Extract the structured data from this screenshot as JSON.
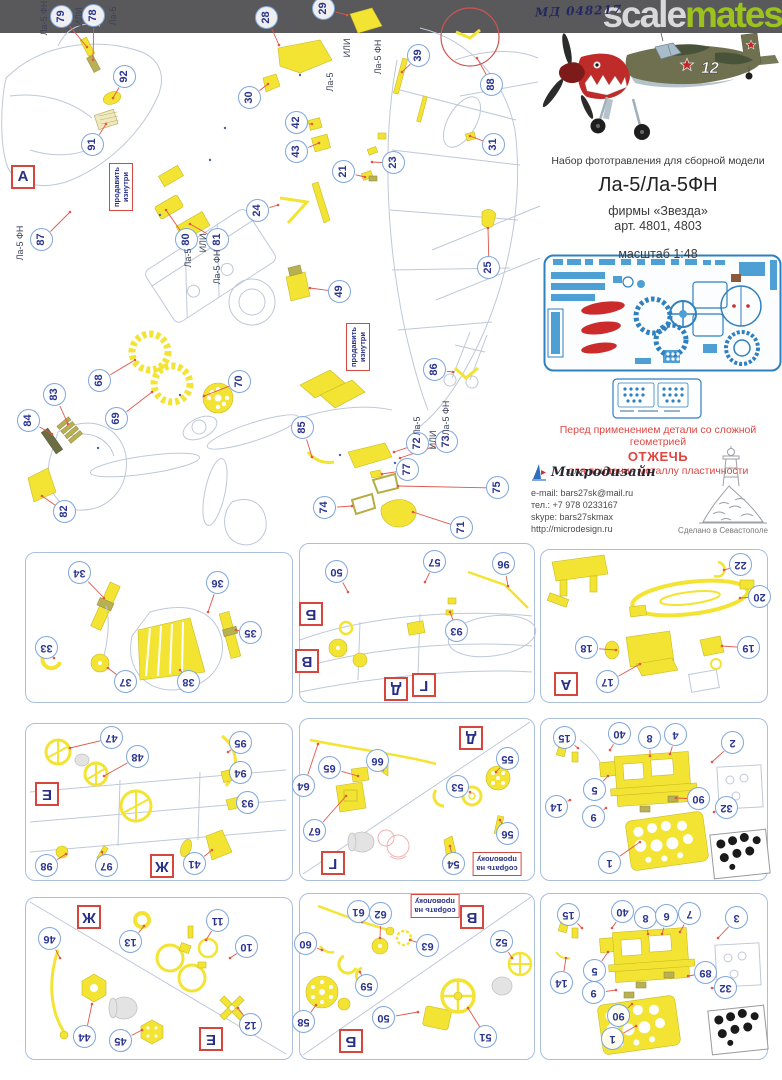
{
  "header": {
    "code": "МД 048217",
    "brand_gray": "scale",
    "brand_green": "mates"
  },
  "photo": {
    "number": "12"
  },
  "product": {
    "description": "Набор фототравления для сборной модели",
    "title": "Ла-5/Ла-5ФН",
    "brand": "фирмы «Звезда»",
    "articles": "арт. 4801, 4803",
    "scale": "масштаб 1:48"
  },
  "warning": {
    "line1": "Перед применением детали со сложной геометрией",
    "line2": "ОТЖЕЧЬ",
    "line3": "для придания металлу пластичности"
  },
  "publisher": {
    "name": "Микродизайн",
    "email": "e-mail: bars27sk@mail.ru",
    "phone": "тел.: +7 978 0233167",
    "skype": "skype: bars27skmax",
    "site": "http://microdesign.ru",
    "made_in": "Сделано в Севастополе"
  },
  "colors": {
    "accent_green": "#9cc21e",
    "callout_blue": "#2b3590",
    "leader_red": "#e2564b",
    "part_yellow": "#f3e433"
  },
  "diagram": {
    "markers": [
      {
        "t": "А",
        "x": 23,
        "y": 177
      }
    ],
    "labels": [
      {
        "t": "Ла-5 ФН",
        "x": 44,
        "y": 18
      },
      {
        "t": "ИЛИ",
        "x": 79,
        "y": 17
      },
      {
        "t": "Ла-5",
        "x": 113,
        "y": 16
      },
      {
        "t": "ИЛИ",
        "x": 347,
        "y": 48
      },
      {
        "t": "Ла-5 ФН",
        "x": 378,
        "y": 57
      },
      {
        "t": "Ла-5",
        "x": 330,
        "y": 82
      },
      {
        "t": "Ла-5 ФН",
        "x": 20,
        "y": 243
      },
      {
        "t": "Ла-5",
        "x": 188,
        "y": 258
      },
      {
        "t": "ИЛИ",
        "x": 203,
        "y": 243
      },
      {
        "t": "Ла-5 ФН",
        "x": 217,
        "y": 267
      },
      {
        "t": "Ла-5",
        "x": 417,
        "y": 426
      },
      {
        "t": "ИЛИ",
        "x": 433,
        "y": 440
      },
      {
        "t": "Ла-5 ФН",
        "x": 446,
        "y": 418
      }
    ],
    "notes": [
      {
        "lines": [
          "продавить",
          "изнутри"
        ],
        "x": 121,
        "y": 187
      },
      {
        "lines": [
          "продавить",
          "изнутри"
        ],
        "x": 358,
        "y": 347
      }
    ],
    "callouts": [
      {
        "n": "79",
        "x": 62,
        "y": 17,
        "tx": 87,
        "ty": 47
      },
      {
        "n": "78",
        "x": 94,
        "y": 16,
        "tx": 93,
        "ty": 60
      },
      {
        "n": "92",
        "x": 125,
        "y": 77,
        "tx": 113,
        "ty": 98
      },
      {
        "n": "91",
        "x": 93,
        "y": 145,
        "tx": 106,
        "ty": 124
      },
      {
        "n": "87",
        "x": 42,
        "y": 240,
        "tx": 70,
        "ty": 212
      },
      {
        "n": "80",
        "x": 187,
        "y": 240,
        "tx": 166,
        "ty": 210
      },
      {
        "n": "81",
        "x": 218,
        "y": 240,
        "tx": 190,
        "ty": 224
      },
      {
        "n": "28",
        "x": 267,
        "y": 18,
        "tx": 279,
        "ty": 45
      },
      {
        "n": "29",
        "x": 324,
        "y": 9,
        "tx": 347,
        "ty": 15
      },
      {
        "n": "30",
        "x": 250,
        "y": 98,
        "tx": 268,
        "ty": 84
      },
      {
        "n": "39",
        "x": 419,
        "y": 56,
        "tx": 402,
        "ty": 72
      },
      {
        "n": "88",
        "x": 492,
        "y": 85,
        "tx": 477,
        "ty": 58
      },
      {
        "n": "31",
        "x": 494,
        "y": 145,
        "tx": 470,
        "ty": 136
      },
      {
        "n": "42",
        "x": 297,
        "y": 123,
        "tx": 312,
        "ty": 124
      },
      {
        "n": "43",
        "x": 297,
        "y": 152,
        "tx": 319,
        "ty": 143
      },
      {
        "n": "21",
        "x": 344,
        "y": 172,
        "tx": 365,
        "ty": 177
      },
      {
        "n": "23",
        "x": 394,
        "y": 163,
        "tx": 372,
        "ty": 162
      },
      {
        "n": "24",
        "x": 258,
        "y": 211,
        "tx": 278,
        "ty": 205
      },
      {
        "n": "49",
        "x": 340,
        "y": 292,
        "tx": 310,
        "ty": 288
      },
      {
        "n": "25",
        "x": 489,
        "y": 268,
        "tx": 488,
        "ty": 228
      },
      {
        "n": "68",
        "x": 100,
        "y": 381,
        "tx": 135,
        "ty": 360
      },
      {
        "n": "83",
        "x": 55,
        "y": 395,
        "tx": 68,
        "ty": 424
      },
      {
        "n": "84",
        "x": 29,
        "y": 421,
        "tx": 52,
        "ty": 434
      },
      {
        "n": "69",
        "x": 117,
        "y": 419,
        "tx": 152,
        "ty": 392
      },
      {
        "n": "70",
        "x": 240,
        "y": 382,
        "tx": 204,
        "ty": 396
      },
      {
        "n": "82",
        "x": 65,
        "y": 512,
        "tx": 42,
        "ty": 496
      },
      {
        "n": "86",
        "x": 435,
        "y": 370,
        "tx": 453,
        "ty": 372
      },
      {
        "n": "85",
        "x": 303,
        "y": 428,
        "tx": 312,
        "ty": 457
      },
      {
        "n": "72",
        "x": 418,
        "y": 444,
        "tx": 394,
        "ty": 452
      },
      {
        "n": "73",
        "x": 447,
        "y": 442,
        "tx": 400,
        "ty": 458
      },
      {
        "n": "77",
        "x": 408,
        "y": 470,
        "tx": 382,
        "ty": 474
      },
      {
        "n": "75",
        "x": 498,
        "y": 488,
        "tx": 398,
        "ty": 486
      },
      {
        "n": "74",
        "x": 325,
        "y": 508,
        "tx": 352,
        "ty": 506
      },
      {
        "n": "71",
        "x": 462,
        "y": 528,
        "tx": 413,
        "ty": 512
      }
    ]
  },
  "panels": [
    {
      "id": "panel-1",
      "x": 25,
      "y": 552,
      "w": 266,
      "h": 149,
      "letters": [],
      "notes": [],
      "callouts": [
        {
          "n": "34",
          "x": 80,
          "y": 573,
          "tx": 104,
          "ty": 598
        },
        {
          "n": "36",
          "x": 218,
          "y": 583,
          "tx": 208,
          "ty": 612
        },
        {
          "n": "33",
          "x": 47,
          "y": 648,
          "tx": 54,
          "ty": 658
        },
        {
          "n": "35",
          "x": 251,
          "y": 633,
          "tx": 236,
          "ty": 630
        },
        {
          "n": "37",
          "x": 126,
          "y": 682,
          "tx": 108,
          "ty": 668
        },
        {
          "n": "38",
          "x": 189,
          "y": 682,
          "tx": 180,
          "ty": 670
        }
      ]
    },
    {
      "id": "panel-2",
      "x": 299,
      "y": 543,
      "w": 234,
      "h": 158,
      "letters": [
        {
          "t": "Б",
          "x": 311,
          "y": 614
        },
        {
          "t": "В",
          "x": 307,
          "y": 661
        },
        {
          "t": "Д",
          "x": 396,
          "y": 689
        },
        {
          "t": "Г",
          "x": 424,
          "y": 685
        }
      ],
      "notes": [],
      "callouts": [
        {
          "n": "50",
          "x": 337,
          "y": 572,
          "tx": 348,
          "ty": 592
        },
        {
          "n": "57",
          "x": 435,
          "y": 562,
          "tx": 425,
          "ty": 582
        },
        {
          "n": "96",
          "x": 504,
          "y": 564,
          "tx": 508,
          "ty": 586
        },
        {
          "n": "93",
          "x": 457,
          "y": 631,
          "tx": 450,
          "ty": 612
        }
      ]
    },
    {
      "id": "panel-3",
      "x": 540,
      "y": 549,
      "w": 226,
      "h": 152,
      "letters": [
        {
          "t": "А",
          "x": 566,
          "y": 684
        }
      ],
      "notes": [],
      "callouts": [
        {
          "n": "22",
          "x": 741,
          "y": 565,
          "tx": 724,
          "ty": 570
        },
        {
          "n": "20",
          "x": 760,
          "y": 597,
          "tx": 740,
          "ty": 598
        },
        {
          "n": "18",
          "x": 587,
          "y": 648,
          "tx": 616,
          "ty": 650
        },
        {
          "n": "19",
          "x": 749,
          "y": 648,
          "tx": 722,
          "ty": 646
        },
        {
          "n": "17",
          "x": 608,
          "y": 682,
          "tx": 640,
          "ty": 664
        }
      ]
    },
    {
      "id": "panel-4",
      "x": 25,
      "y": 723,
      "w": 266,
      "h": 156,
      "letters": [
        {
          "t": "Е",
          "x": 47,
          "y": 794
        },
        {
          "t": "Ж",
          "x": 162,
          "y": 866
        }
      ],
      "notes": [],
      "callouts": [
        {
          "n": "47",
          "x": 112,
          "y": 738,
          "tx": 70,
          "ty": 748
        },
        {
          "n": "48",
          "x": 138,
          "y": 757,
          "tx": 104,
          "ty": 776
        },
        {
          "n": "95",
          "x": 241,
          "y": 743,
          "tx": 228,
          "ty": 752
        },
        {
          "n": "94",
          "x": 241,
          "y": 773,
          "tx": 232,
          "ty": 774
        },
        {
          "n": "93",
          "x": 248,
          "y": 803,
          "tx": 238,
          "ty": 800
        },
        {
          "n": "98",
          "x": 47,
          "y": 866,
          "tx": 66,
          "ty": 854
        },
        {
          "n": "97",
          "x": 107,
          "y": 866,
          "tx": 102,
          "ty": 852
        },
        {
          "n": "41",
          "x": 195,
          "y": 864,
          "tx": 212,
          "ty": 850
        }
      ]
    },
    {
      "id": "panel-5",
      "x": 299,
      "y": 718,
      "w": 234,
      "h": 161,
      "letters": [
        {
          "t": "Д",
          "x": 471,
          "y": 738
        },
        {
          "t": "Г",
          "x": 333,
          "y": 863
        }
      ],
      "notes": [
        {
          "lines": [
            "собрать на",
            "проволоку"
          ],
          "x": 497,
          "y": 864
        }
      ],
      "callouts": [
        {
          "n": "64",
          "x": 304,
          "y": 786,
          "tx": 318,
          "ty": 744
        },
        {
          "n": "65",
          "x": 330,
          "y": 768,
          "tx": 358,
          "ty": 776
        },
        {
          "n": "66",
          "x": 378,
          "y": 761,
          "tx": 382,
          "ty": 768
        },
        {
          "n": "67",
          "x": 315,
          "y": 831,
          "tx": 346,
          "ty": 796
        },
        {
          "n": "55",
          "x": 508,
          "y": 759,
          "tx": 496,
          "ty": 772
        },
        {
          "n": "53",
          "x": 458,
          "y": 787,
          "tx": 470,
          "ty": 792
        },
        {
          "n": "56",
          "x": 508,
          "y": 834,
          "tx": 500,
          "ty": 820
        },
        {
          "n": "54",
          "x": 454,
          "y": 864,
          "tx": 450,
          "ty": 846
        }
      ]
    },
    {
      "id": "panel-6",
      "x": 540,
      "y": 718,
      "w": 226,
      "h": 161,
      "letters": [],
      "notes": [],
      "callouts": [
        {
          "n": "15",
          "x": 565,
          "y": 738,
          "tx": 578,
          "ty": 748
        },
        {
          "n": "40",
          "x": 620,
          "y": 734,
          "tx": 610,
          "ty": 750
        },
        {
          "n": "8",
          "x": 650,
          "y": 738,
          "tx": 650,
          "ty": 756
        },
        {
          "n": "4",
          "x": 676,
          "y": 735,
          "tx": 670,
          "ty": 754
        },
        {
          "n": "2",
          "x": 733,
          "y": 743,
          "tx": 712,
          "ty": 762
        },
        {
          "n": "5",
          "x": 595,
          "y": 790,
          "tx": 608,
          "ty": 776
        },
        {
          "n": "14",
          "x": 557,
          "y": 807,
          "tx": 570,
          "ty": 800
        },
        {
          "n": "9",
          "x": 594,
          "y": 817,
          "tx": 606,
          "ty": 808
        },
        {
          "n": "90",
          "x": 699,
          "y": 799,
          "tx": 676,
          "ty": 798
        },
        {
          "n": "32",
          "x": 727,
          "y": 808,
          "tx": 714,
          "ty": 812
        },
        {
          "n": "1",
          "x": 610,
          "y": 863,
          "tx": 640,
          "ty": 842
        }
      ]
    },
    {
      "id": "panel-7",
      "x": 25,
      "y": 897,
      "w": 266,
      "h": 161,
      "letters": [
        {
          "t": "Ж",
          "x": 89,
          "y": 917
        },
        {
          "t": "Е",
          "x": 211,
          "y": 1039
        }
      ],
      "notes": [],
      "callouts": [
        {
          "n": "46",
          "x": 50,
          "y": 939,
          "tx": 60,
          "ty": 958
        },
        {
          "n": "13",
          "x": 131,
          "y": 942,
          "tx": 144,
          "ty": 926
        },
        {
          "n": "11",
          "x": 218,
          "y": 921,
          "tx": 206,
          "ty": 940
        },
        {
          "n": "10",
          "x": 247,
          "y": 947,
          "tx": 230,
          "ty": 958
        },
        {
          "n": "12",
          "x": 251,
          "y": 1025,
          "tx": 238,
          "ty": 1008
        },
        {
          "n": "44",
          "x": 85,
          "y": 1037,
          "tx": 92,
          "ty": 1004
        },
        {
          "n": "45",
          "x": 121,
          "y": 1041,
          "tx": 142,
          "ty": 1030
        }
      ]
    },
    {
      "id": "panel-8",
      "x": 299,
      "y": 893,
      "w": 234,
      "h": 165,
      "letters": [
        {
          "t": "В",
          "x": 472,
          "y": 917
        },
        {
          "t": "Б",
          "x": 351,
          "y": 1041
        }
      ],
      "notes": [
        {
          "lines": [
            "собрать на",
            "проволоку"
          ],
          "x": 435,
          "y": 906
        }
      ],
      "callouts": [
        {
          "n": "61",
          "x": 359,
          "y": 912,
          "tx": 362,
          "ty": 922
        },
        {
          "n": "62",
          "x": 381,
          "y": 914,
          "tx": 380,
          "ty": 938
        },
        {
          "n": "63",
          "x": 428,
          "y": 946,
          "tx": 410,
          "ty": 940
        },
        {
          "n": "60",
          "x": 306,
          "y": 944,
          "tx": 322,
          "ty": 950
        },
        {
          "n": "59",
          "x": 367,
          "y": 986,
          "tx": 360,
          "ty": 972
        },
        {
          "n": "58",
          "x": 304,
          "y": 1022,
          "tx": 316,
          "ty": 1005
        },
        {
          "n": "50",
          "x": 384,
          "y": 1018,
          "tx": 418,
          "ty": 1012
        },
        {
          "n": "52",
          "x": 502,
          "y": 942,
          "tx": 512,
          "ty": 958
        },
        {
          "n": "51",
          "x": 486,
          "y": 1037,
          "tx": 468,
          "ty": 1008
        }
      ]
    },
    {
      "id": "panel-9",
      "x": 540,
      "y": 893,
      "w": 226,
      "h": 165,
      "letters": [],
      "notes": [],
      "callouts": [
        {
          "n": "15",
          "x": 569,
          "y": 915,
          "tx": 582,
          "ty": 928
        },
        {
          "n": "40",
          "x": 623,
          "y": 912,
          "tx": 612,
          "ty": 928
        },
        {
          "n": "8",
          "x": 646,
          "y": 918,
          "tx": 648,
          "ty": 934
        },
        {
          "n": "6",
          "x": 667,
          "y": 916,
          "tx": 662,
          "ty": 934
        },
        {
          "n": "7",
          "x": 690,
          "y": 914,
          "tx": 680,
          "ty": 932
        },
        {
          "n": "3",
          "x": 737,
          "y": 918,
          "tx": 718,
          "ty": 938
        },
        {
          "n": "5",
          "x": 595,
          "y": 971,
          "tx": 608,
          "ty": 952
        },
        {
          "n": "14",
          "x": 562,
          "y": 983,
          "tx": 566,
          "ty": 958
        },
        {
          "n": "9",
          "x": 594,
          "y": 993,
          "tx": 616,
          "ty": 990
        },
        {
          "n": "89",
          "x": 706,
          "y": 973,
          "tx": 688,
          "ty": 976
        },
        {
          "n": "32",
          "x": 726,
          "y": 988,
          "tx": 712,
          "ty": 988
        },
        {
          "n": "90",
          "x": 619,
          "y": 1016,
          "tx": 632,
          "ty": 1004
        },
        {
          "n": "1",
          "x": 613,
          "y": 1039,
          "tx": 636,
          "ty": 1026
        }
      ]
    }
  ]
}
